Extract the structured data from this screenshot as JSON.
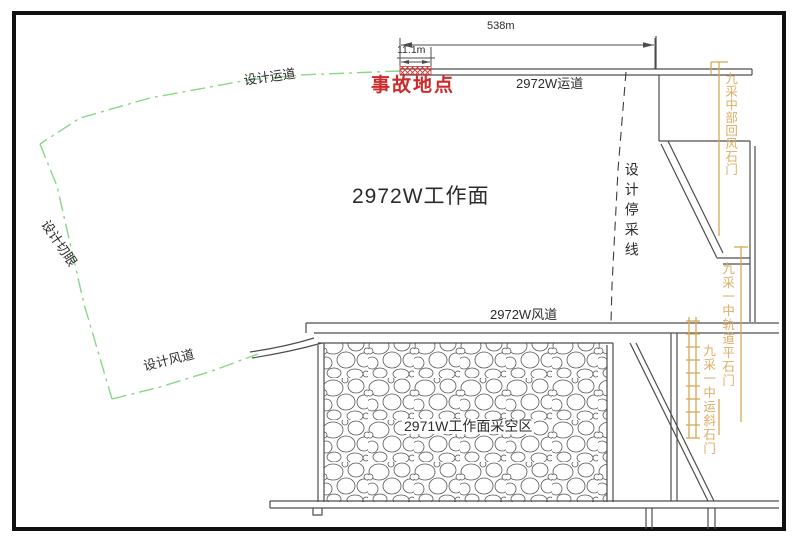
{
  "labels": {
    "face": "2972W工作面",
    "goaf": "2971W工作面采空区",
    "accident": "事故地点",
    "top_roadway": "2972W运道",
    "air_roadway": "2972W风道",
    "design_haulage": "设计运道",
    "design_air": "设计风道",
    "design_cut": "设计切眼",
    "stop_mining_line": "设计停采线",
    "dim_total": "538m",
    "dim_accident": "11.1m",
    "crosscut_return_air": "九采中部回风石门",
    "crosscut_track": "九采一中轨道平石门",
    "crosscut_incline": "九采一中运斜石门"
  },
  "colors": {
    "line": "#4d4d4d",
    "green": "#86d986",
    "orange_line": "#d8a855",
    "orange_text": "#ddae66",
    "red": "#cc2b2b",
    "border": "#111111"
  }
}
